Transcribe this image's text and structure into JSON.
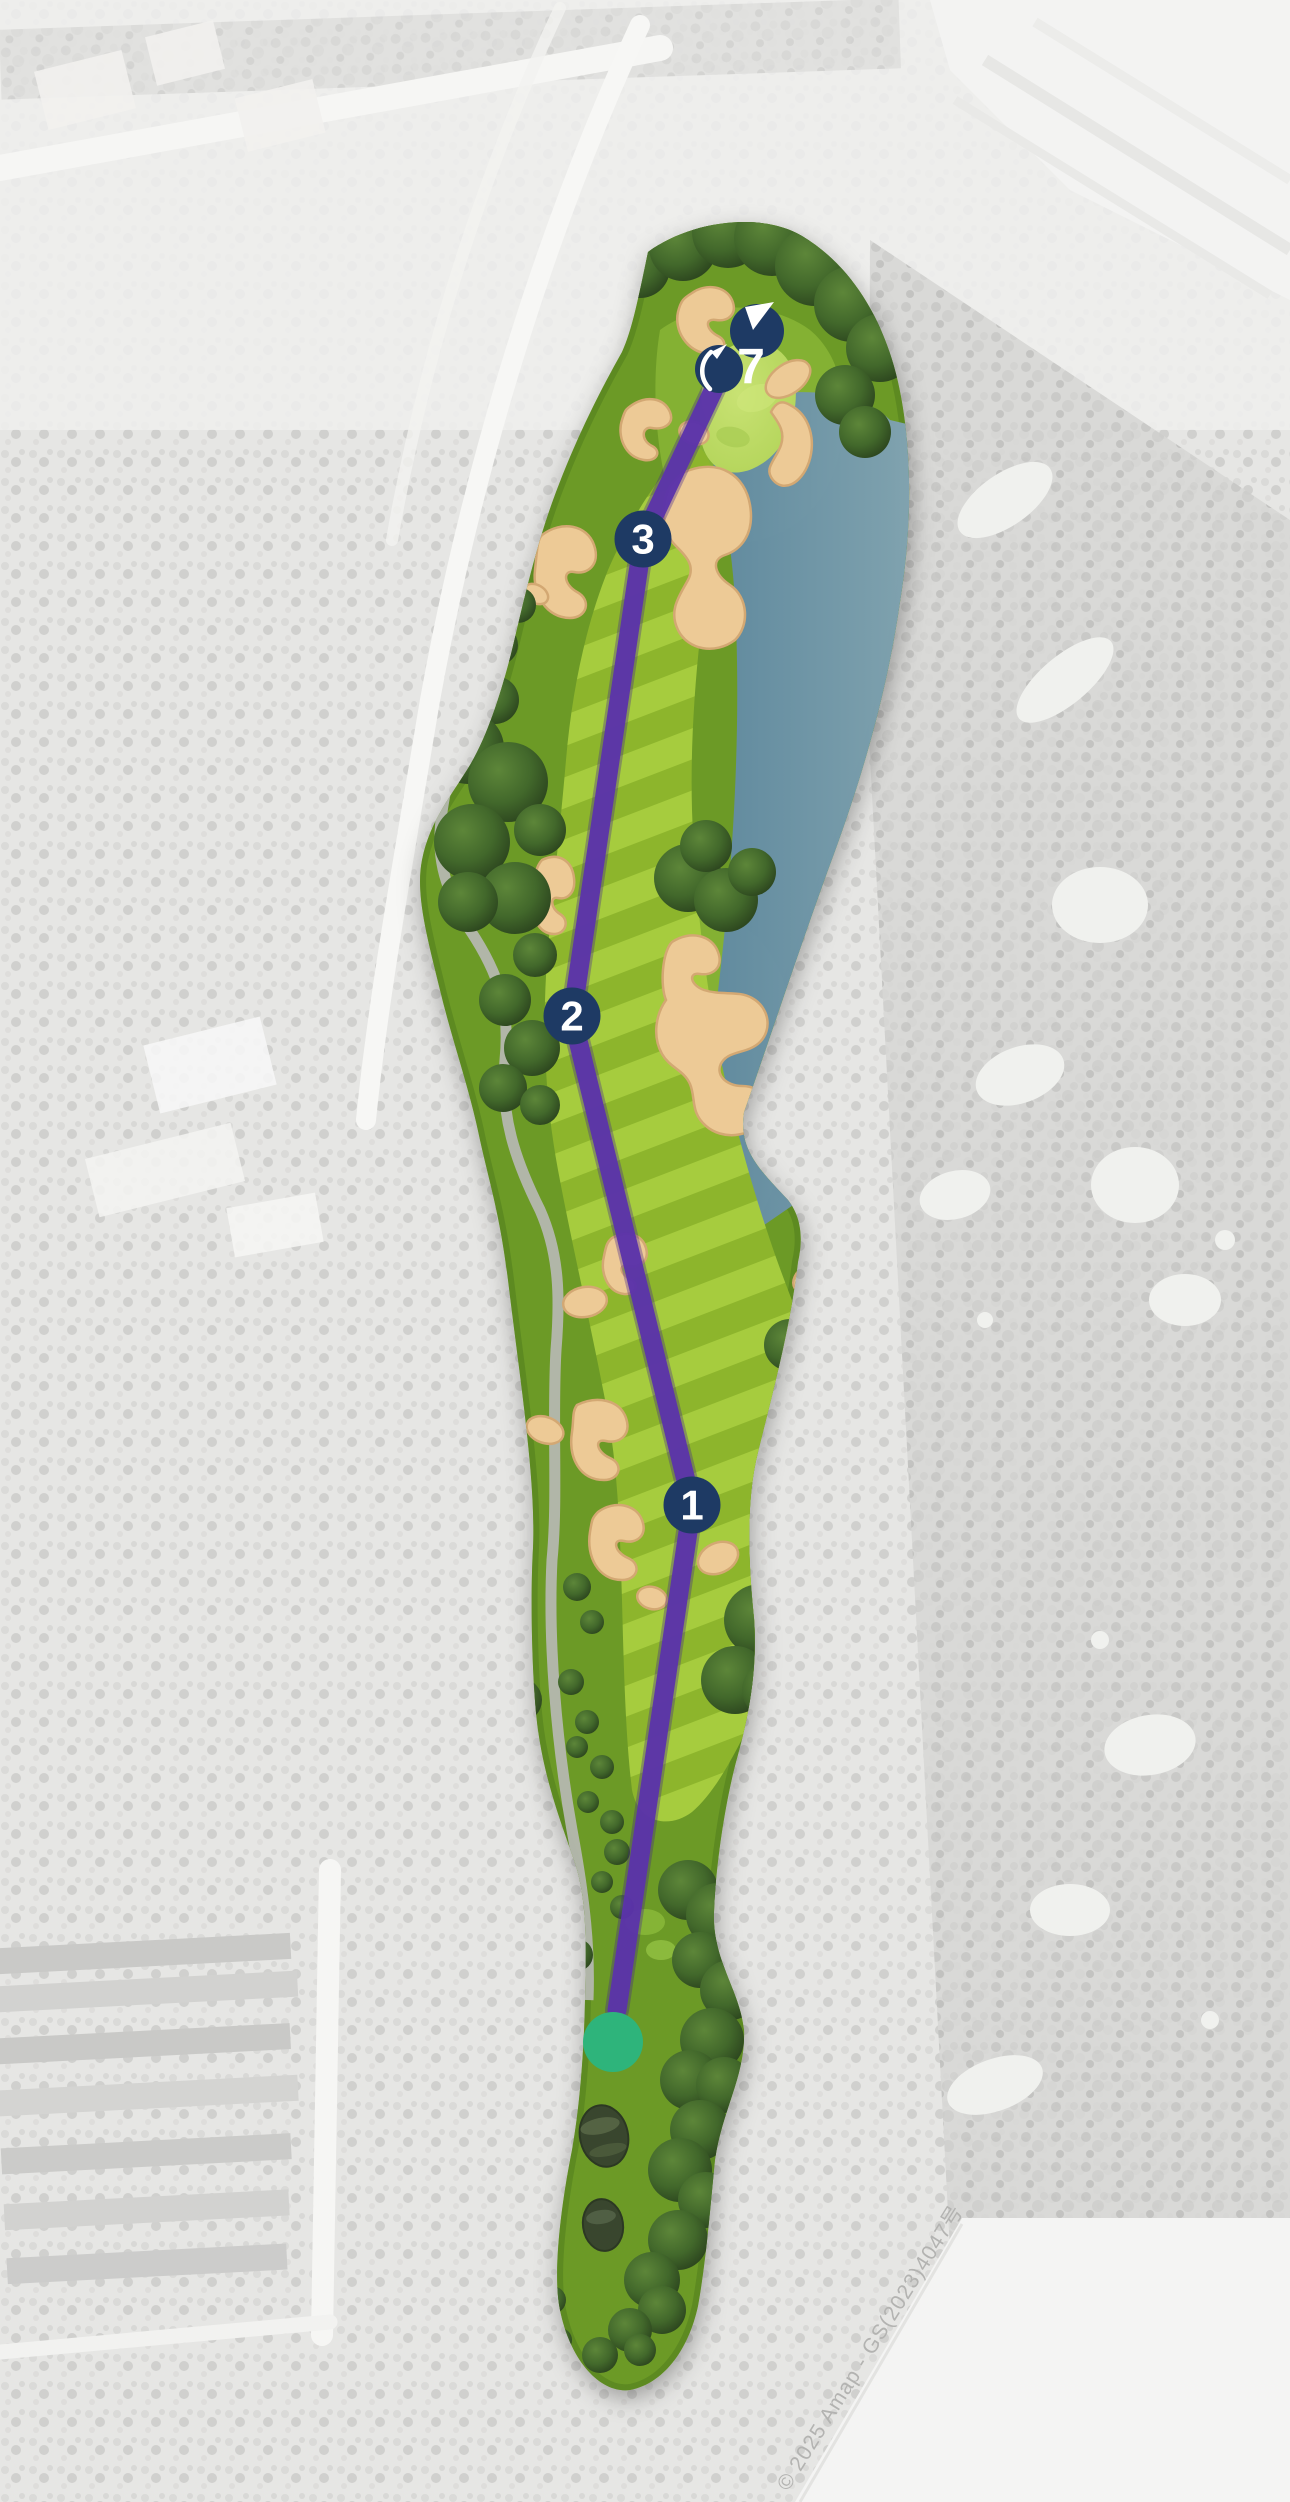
{
  "map": {
    "attribution": "© 2025 Amap - GS(2023)4047号",
    "hole": {
      "green_marker": {
        "hole_number": "7",
        "icons": [
          "pennant-icon",
          "flag-icon"
        ]
      },
      "waypoints": [
        {
          "label": "1"
        },
        {
          "label": "2"
        },
        {
          "label": "3"
        }
      ]
    },
    "colors": {
      "marker_navy": "#1e3a64",
      "route_purple": "#5b33ab",
      "route_edge": "#46258c",
      "tee_green": "#2eb47b",
      "water_blue": "#5d87a0",
      "fairway_light_stripe": "#a6cc3e",
      "fairway_dark_stripe": "#8db52c",
      "rough_green": "#6c9a26",
      "bunker_sand": "#edca96"
    }
  }
}
